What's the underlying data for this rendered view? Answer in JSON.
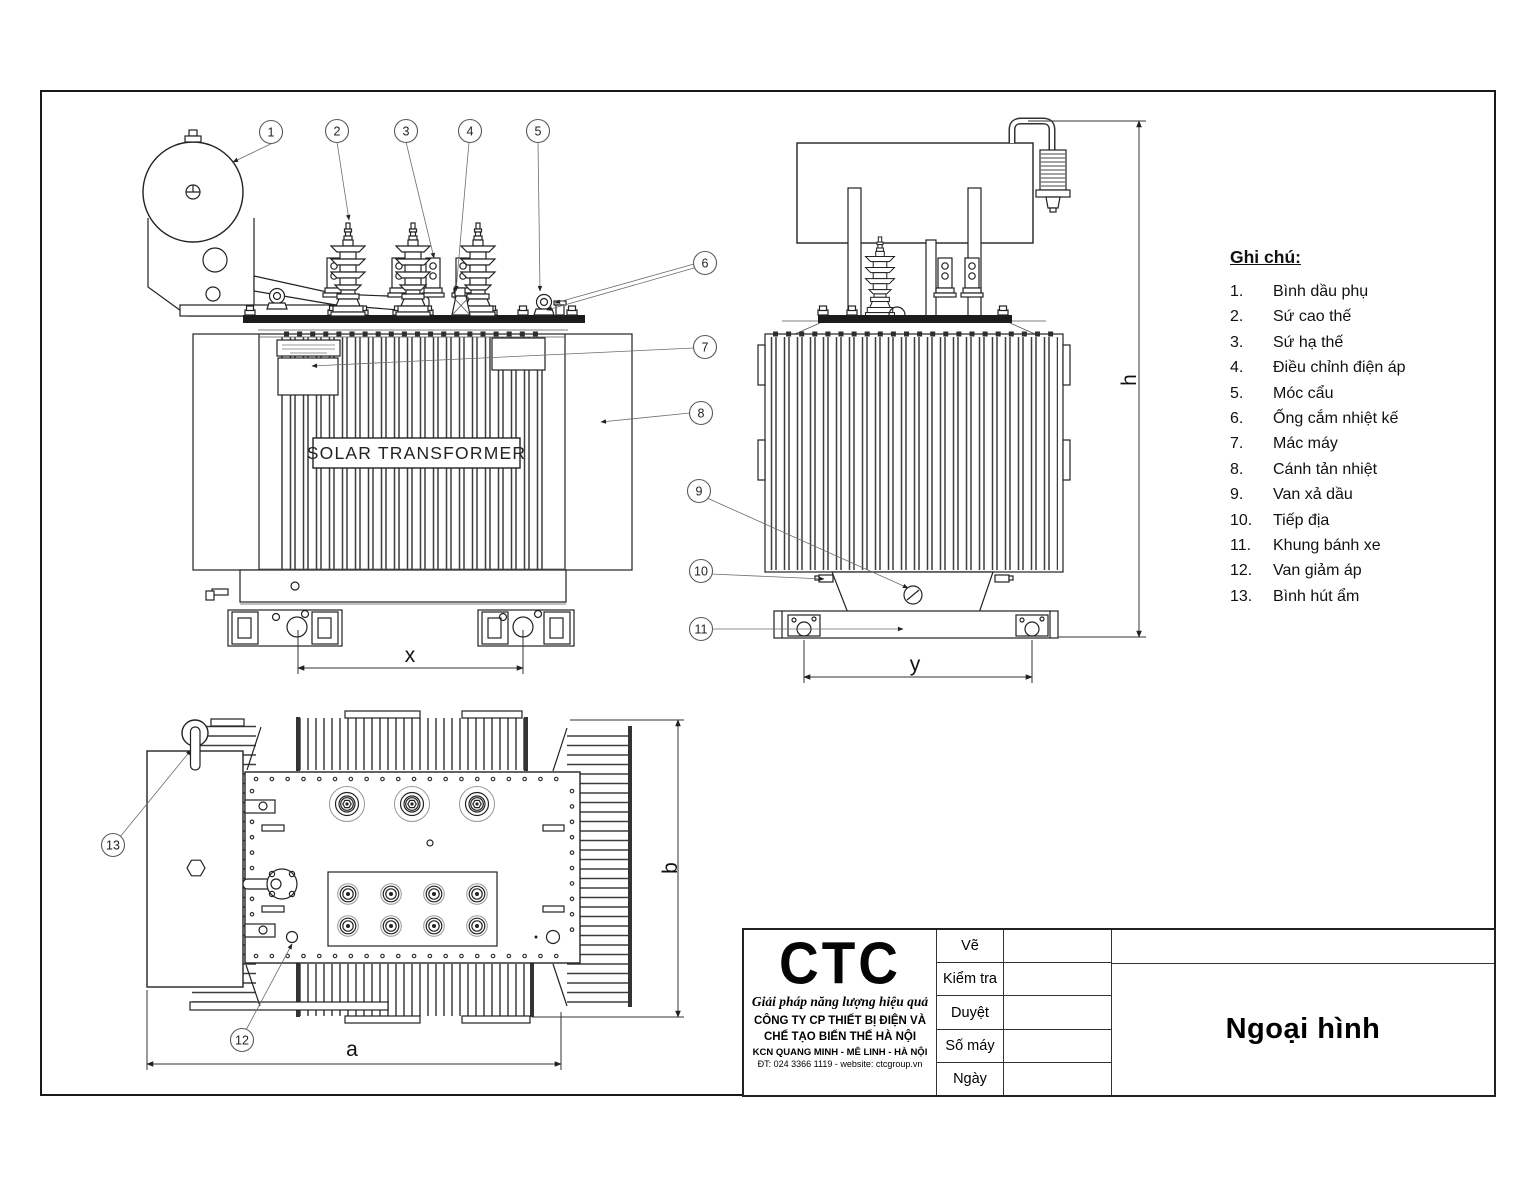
{
  "drawing": {
    "tank_label": "SOLAR TRANSFORMER",
    "dimension_labels": {
      "x": "x",
      "y": "y",
      "h": "h",
      "a": "a",
      "b": "b"
    },
    "callout_numbers": [
      "1",
      "2",
      "3",
      "4",
      "5",
      "6",
      "7",
      "8",
      "9",
      "10",
      "11",
      "12",
      "13"
    ]
  },
  "legend": {
    "title": "Ghi chú:",
    "items": [
      {
        "num": "1.",
        "label": "Bình dầu phụ"
      },
      {
        "num": "2.",
        "label": "Sứ cao thế"
      },
      {
        "num": "3.",
        "label": "Sứ hạ thế"
      },
      {
        "num": "4.",
        "label": "Điều chỉnh điện áp"
      },
      {
        "num": "5.",
        "label": "Móc cẩu"
      },
      {
        "num": "6.",
        "label": "Ống cắm nhiệt kế"
      },
      {
        "num": "7.",
        "label": "Mác máy"
      },
      {
        "num": "8.",
        "label": "Cánh tản nhiệt"
      },
      {
        "num": "9.",
        "label": "Van xả dầu"
      },
      {
        "num": "10.",
        "label": "Tiếp địa"
      },
      {
        "num": "11.",
        "label": "Khung bánh xe"
      },
      {
        "num": "12.",
        "label": "Van giảm áp"
      },
      {
        "num": "13.",
        "label": "Bình hút ẩm"
      }
    ]
  },
  "title_block": {
    "logo": "CTC",
    "slogan": "Giải pháp năng lượng hiệu quả",
    "company_line1": "CÔNG TY CP THIẾT BỊ ĐIỆN VÀ",
    "company_line2": "CHẾ TẠO BIẾN THẾ HÀ NỘI",
    "address": "KCN QUANG MINH - MÊ LINH - HÀ NỘI",
    "contact": "ĐT: 024 3366 1119 - website: ctcgroup.vn",
    "rows": [
      {
        "label": "Vẽ"
      },
      {
        "label": "Kiểm tra"
      },
      {
        "label": "Duyệt"
      },
      {
        "label": "Số máy"
      },
      {
        "label": "Ngày"
      }
    ],
    "drawing_title": "Ngoại hình"
  }
}
